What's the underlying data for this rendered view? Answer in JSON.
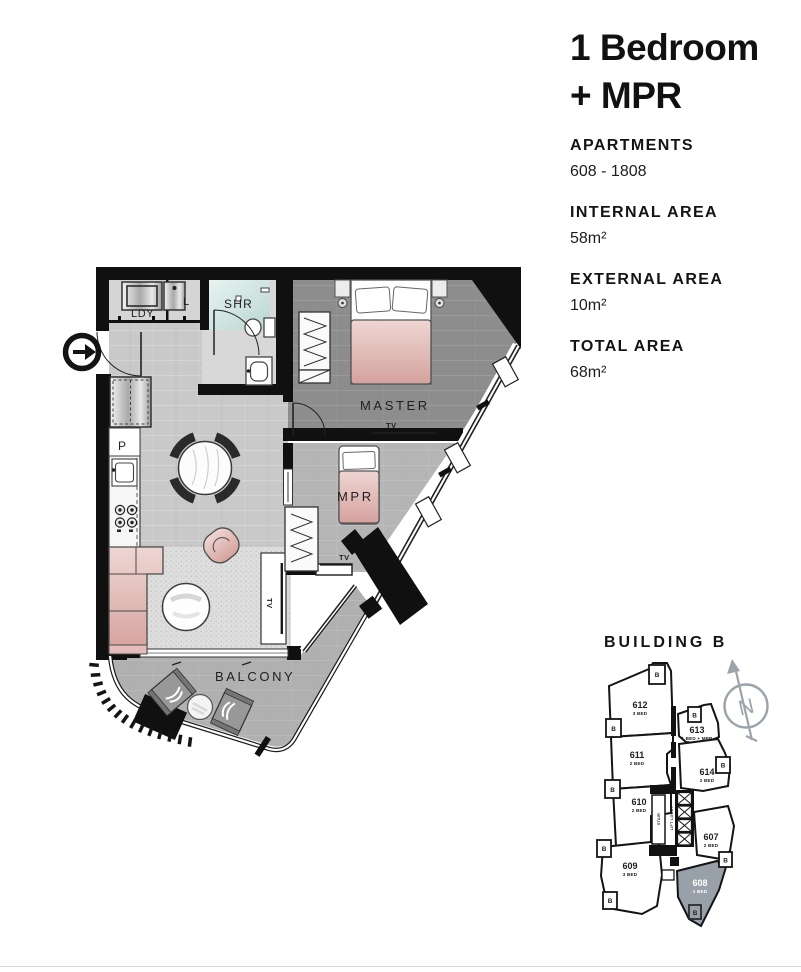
{
  "panel": {
    "title_line1": "1 Bedroom",
    "title_line2": "+ MPR",
    "specs": [
      {
        "label": "APARTMENTS",
        "value": "608 - 1808"
      },
      {
        "label": "INTERNAL AREA",
        "value": "58m²"
      },
      {
        "label": "EXTERNAL AREA",
        "value": "10m²"
      },
      {
        "label": "TOTAL AREA",
        "value": "68m²"
      }
    ]
  },
  "plan": {
    "labels": {
      "laundry": "LDY",
      "linen": "L",
      "shower": "SHR",
      "pantry": "P",
      "master": "MASTER",
      "mpr": "MPR",
      "balcony": "BALCONY",
      "tv": "TV"
    }
  },
  "key": {
    "title": "BUILDING B",
    "compass_n": "N",
    "balcony_marker": "B",
    "lift_lobby": "LIFT LOBBY",
    "stair": "STAIR",
    "units": [
      {
        "id": "612",
        "type": "3 BED"
      },
      {
        "id": "611",
        "type": "2 BED"
      },
      {
        "id": "610",
        "type": "2 BED"
      },
      {
        "id": "609",
        "type": "3 BED"
      },
      {
        "id": "613",
        "type": "1 BED + MPR"
      },
      {
        "id": "614",
        "type": "2 BED"
      },
      {
        "id": "607",
        "type": "2 BED"
      },
      {
        "id": "608",
        "type": "1 BED",
        "highlighted": true
      }
    ],
    "highlight_color": "#98a1a9"
  },
  "colors": {
    "wall": "#101010",
    "floor_living": "#c9c9c9",
    "floor_master": "#8d8d8d",
    "floor_mpr": "#b5b5b5",
    "floor_balcony": "#b0b0b0",
    "shower_teal": "#bcd8d4",
    "furniture_pink": "#d8a6a2",
    "key_highlight": "#98a1a9",
    "compass_gray": "#9ba4ab"
  }
}
